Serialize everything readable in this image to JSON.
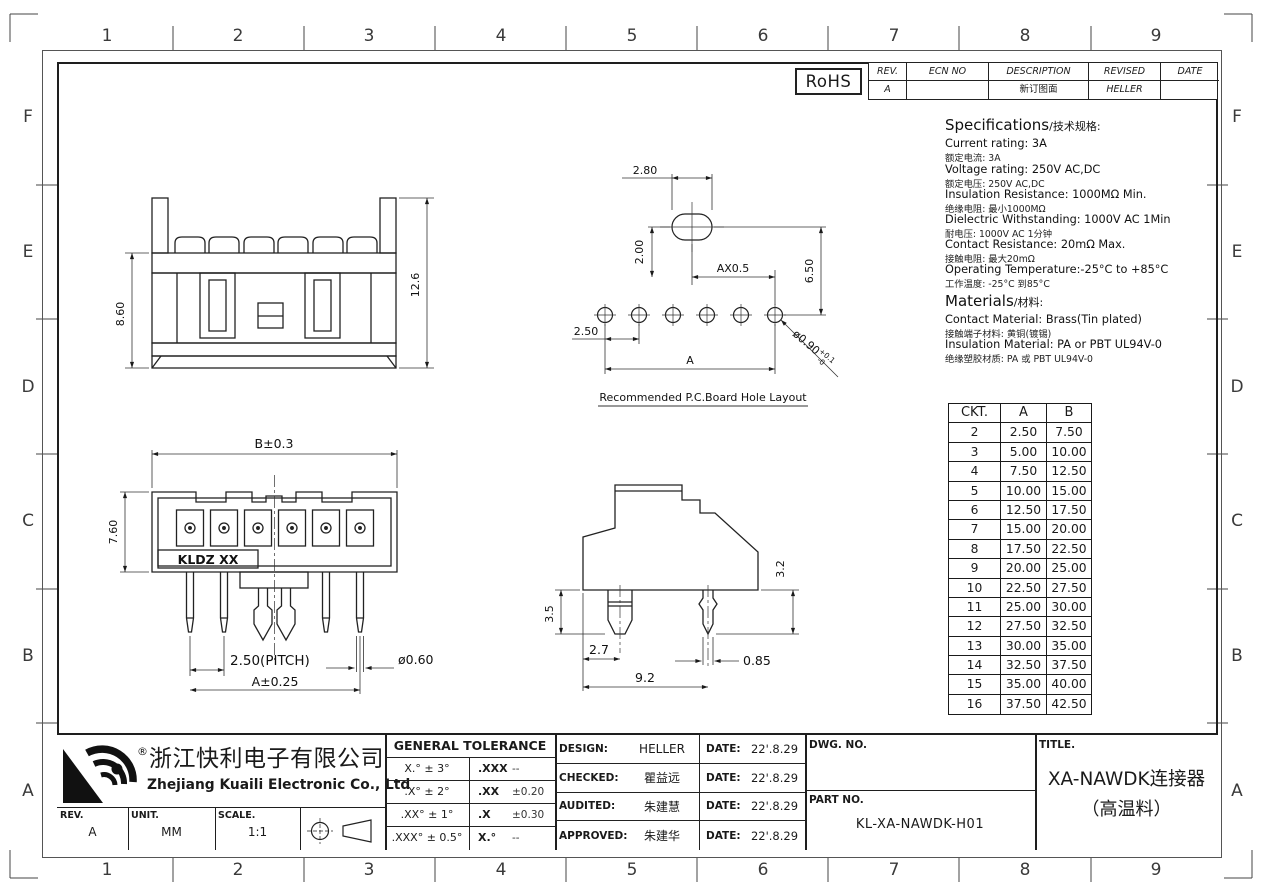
{
  "border": {
    "cols": [
      "1",
      "2",
      "3",
      "4",
      "5",
      "6",
      "7",
      "8",
      "9"
    ],
    "rows": [
      "F",
      "E",
      "D",
      "C",
      "B",
      "A"
    ]
  },
  "badges": {
    "rohs": "RoHS"
  },
  "revision_table": {
    "headers": [
      "REV.",
      "ECN NO",
      "DESCRIPTION",
      "REVISED",
      "DATE"
    ],
    "rows": [
      {
        "rev": "A",
        "ecn": "",
        "description": "新订图面",
        "revised": "HELLER",
        "date": ""
      }
    ]
  },
  "specifications": {
    "title_en": "Specifications",
    "title_zh": "/技术规格:",
    "items": [
      {
        "en": "Current rating: 3A",
        "zh": "额定电流: 3A"
      },
      {
        "en": "Voltage rating: 250V AC,DC",
        "zh": "额定电压: 250V AC,DC"
      },
      {
        "en": "Insulation Resistance: 1000MΩ Min.",
        "zh": "绝缘电阻: 最小1000MΩ"
      },
      {
        "en": "Dielectric Withstanding: 1000V AC 1Min",
        "zh": "耐电压: 1000V AC 1分钟"
      },
      {
        "en": "Contact Resistance: 20mΩ Max.",
        "zh": "接触电阻: 最大20mΩ"
      },
      {
        "en": "Operating Temperature:-25°C to +85°C",
        "zh": "工作温度: -25°C 到85°C"
      }
    ]
  },
  "materials": {
    "title_en": "Materials",
    "title_zh": "/材料:",
    "items": [
      {
        "en": "Contact Material: Brass(Tin plated)",
        "zh": "接触端子材料: 黄铜(镀锡)"
      },
      {
        "en": "Insulation Material: PA or PBT UL94V-0",
        "zh": "绝缘塑胶材质: PA 或 PBT UL94V-0"
      }
    ]
  },
  "ckt_table": {
    "headers": [
      "CKT.",
      "A",
      "B"
    ],
    "rows": [
      [
        "2",
        "2.50",
        "7.50"
      ],
      [
        "3",
        "5.00",
        "10.00"
      ],
      [
        "4",
        "7.50",
        "12.50"
      ],
      [
        "5",
        "10.00",
        "15.00"
      ],
      [
        "6",
        "12.50",
        "17.50"
      ],
      [
        "7",
        "15.00",
        "20.00"
      ],
      [
        "8",
        "17.50",
        "22.50"
      ],
      [
        "9",
        "20.00",
        "25.00"
      ],
      [
        "10",
        "22.50",
        "27.50"
      ],
      [
        "11",
        "25.00",
        "30.00"
      ],
      [
        "12",
        "27.50",
        "32.50"
      ],
      [
        "13",
        "30.00",
        "35.00"
      ],
      [
        "14",
        "32.50",
        "37.50"
      ],
      [
        "15",
        "35.00",
        "40.00"
      ],
      [
        "16",
        "37.50",
        "42.50"
      ]
    ]
  },
  "views": {
    "front_top": {
      "body_height": "8.60",
      "total_height": "12.6"
    },
    "pcb": {
      "oval_w": "2.80",
      "oval_h": "2.00",
      "ax": "AX0.5",
      "drop": "6.50",
      "pitch": "2.50",
      "span": "A",
      "hole_main": "ø0.90",
      "hole_tol_up": "+0.1",
      "hole_tol_dn": "-0",
      "caption": "Recommended  P.C.Board Hole  Layout"
    },
    "front_bottom": {
      "width": "B±0.3",
      "height": "7.60",
      "pitch": "2.50(PITCH)",
      "span": "A±0.25",
      "pin_dia": "ø0.60",
      "marking": "KLDZ XX"
    },
    "side": {
      "peg_len": "3.5",
      "peg_offset": "2.7",
      "depth": "9.2",
      "pin_w": "0.85",
      "pin_len": "3.2"
    }
  },
  "title_block": {
    "company_zh": "浙江快利电子有限公司",
    "company_en": "Zhejiang Kuaili Electronic Co., Ltd",
    "registered": "®",
    "rev_label": "REV.",
    "rev_value": "A",
    "unit_label": "UNIT.",
    "unit_value": "MM",
    "scale_label": "SCALE.",
    "scale_value": "1:1",
    "tolerance": {
      "title": "GENERAL TOLERANCE",
      "rows": [
        {
          "angle": "X.° ± 3°",
          "dim": ".XXX",
          "tol": "--"
        },
        {
          "angle": ".X° ± 2°",
          "dim": ".XX",
          "tol": "±0.20"
        },
        {
          "angle": ".XX° ± 1°",
          "dim": ".X",
          "tol": "±0.30"
        },
        {
          "angle": ".XXX° ± 0.5°",
          "dim": "X.°",
          "tol": "--"
        }
      ]
    },
    "signoff": [
      {
        "role": "DESIGN:",
        "name": "HELLER",
        "date_label": "DATE:",
        "date": "22'.8.29"
      },
      {
        "role": "CHECKED:",
        "name": "瞿益远",
        "date_label": "DATE:",
        "date": "22'.8.29"
      },
      {
        "role": "AUDITED:",
        "name": "朱建慧",
        "date_label": "DATE:",
        "date": "22'.8.29"
      },
      {
        "role": "APPROVED:",
        "name": "朱建华",
        "date_label": "DATE:",
        "date": "22'.8.29"
      }
    ],
    "dwg_no_label": "DWG. NO.",
    "part_no_label": "PART NO.",
    "part_no": "KL-XA-NAWDK-H01",
    "title_label": "TITLE.",
    "product_title_line1": "XA-NAWDK连接器",
    "product_title_line2": "（高温料）"
  }
}
